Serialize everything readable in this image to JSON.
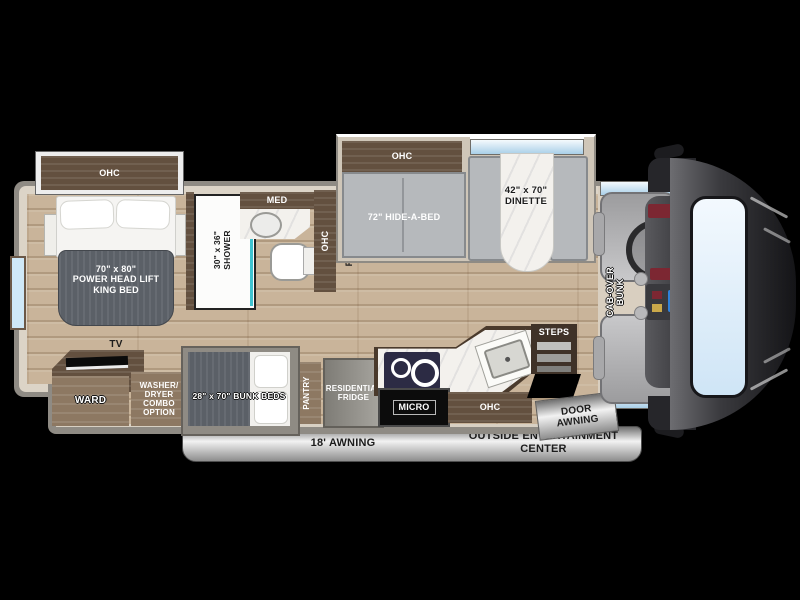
{
  "title": "Class C motorhome floorplan diagram",
  "colors": {
    "background": "#000000",
    "floor_wood": "#c9b49a",
    "wall_outer": "#8f8b84",
    "wall_inner": "#dcd4c7",
    "cabinet_dark": "#63503f",
    "cabinet_wood": "#8d7862",
    "mattress_gray": "#5b6067",
    "seat_gray": "#b6b9bc",
    "counter_marble": "#f3f1ed",
    "window_glass": "#cfe8f7",
    "shower_accent": "#3fc3cf",
    "awning_silver": "#d9d9d9",
    "front_cap": "#232327"
  },
  "areas": {
    "bedroom": {
      "ohc": "OHC",
      "bed": "70\" x 80\"\nPOWER  HEAD LIFT\nKING BED",
      "tv": "TV",
      "ward": "WARD",
      "washer": "WASHER/\nDRYER\nCOMBO\nOPTION"
    },
    "bathroom": {
      "shower": "30\" x 36\"\nSHOWER",
      "med": "MED",
      "ohc": "OHC"
    },
    "living": {
      "fireplace": "FIREPLACE\nW/ 50\" TV",
      "sofa_ohc": "OHC",
      "sofa": "72\" HIDE-A-BED",
      "dinette": "42\" x 70\"\nDINETTE"
    },
    "kitchen": {
      "pantry": "PANTRY",
      "fridge": "RESIDENTIAL\nFRIDGE",
      "micro": "MICRO",
      "ohc": "OHC",
      "steps": "STEPS"
    },
    "bunkroom": {
      "bunks": "28\" x 70\" BUNK BEDS"
    },
    "cab": {
      "bunk": "CAB-OVER\nBUNK"
    },
    "exterior": {
      "door_awning": "DOOR\nAWNING",
      "awning": "18' AWNING",
      "entertainment": "OUTSIDE ENTERTAINMENT\nCENTER"
    }
  }
}
